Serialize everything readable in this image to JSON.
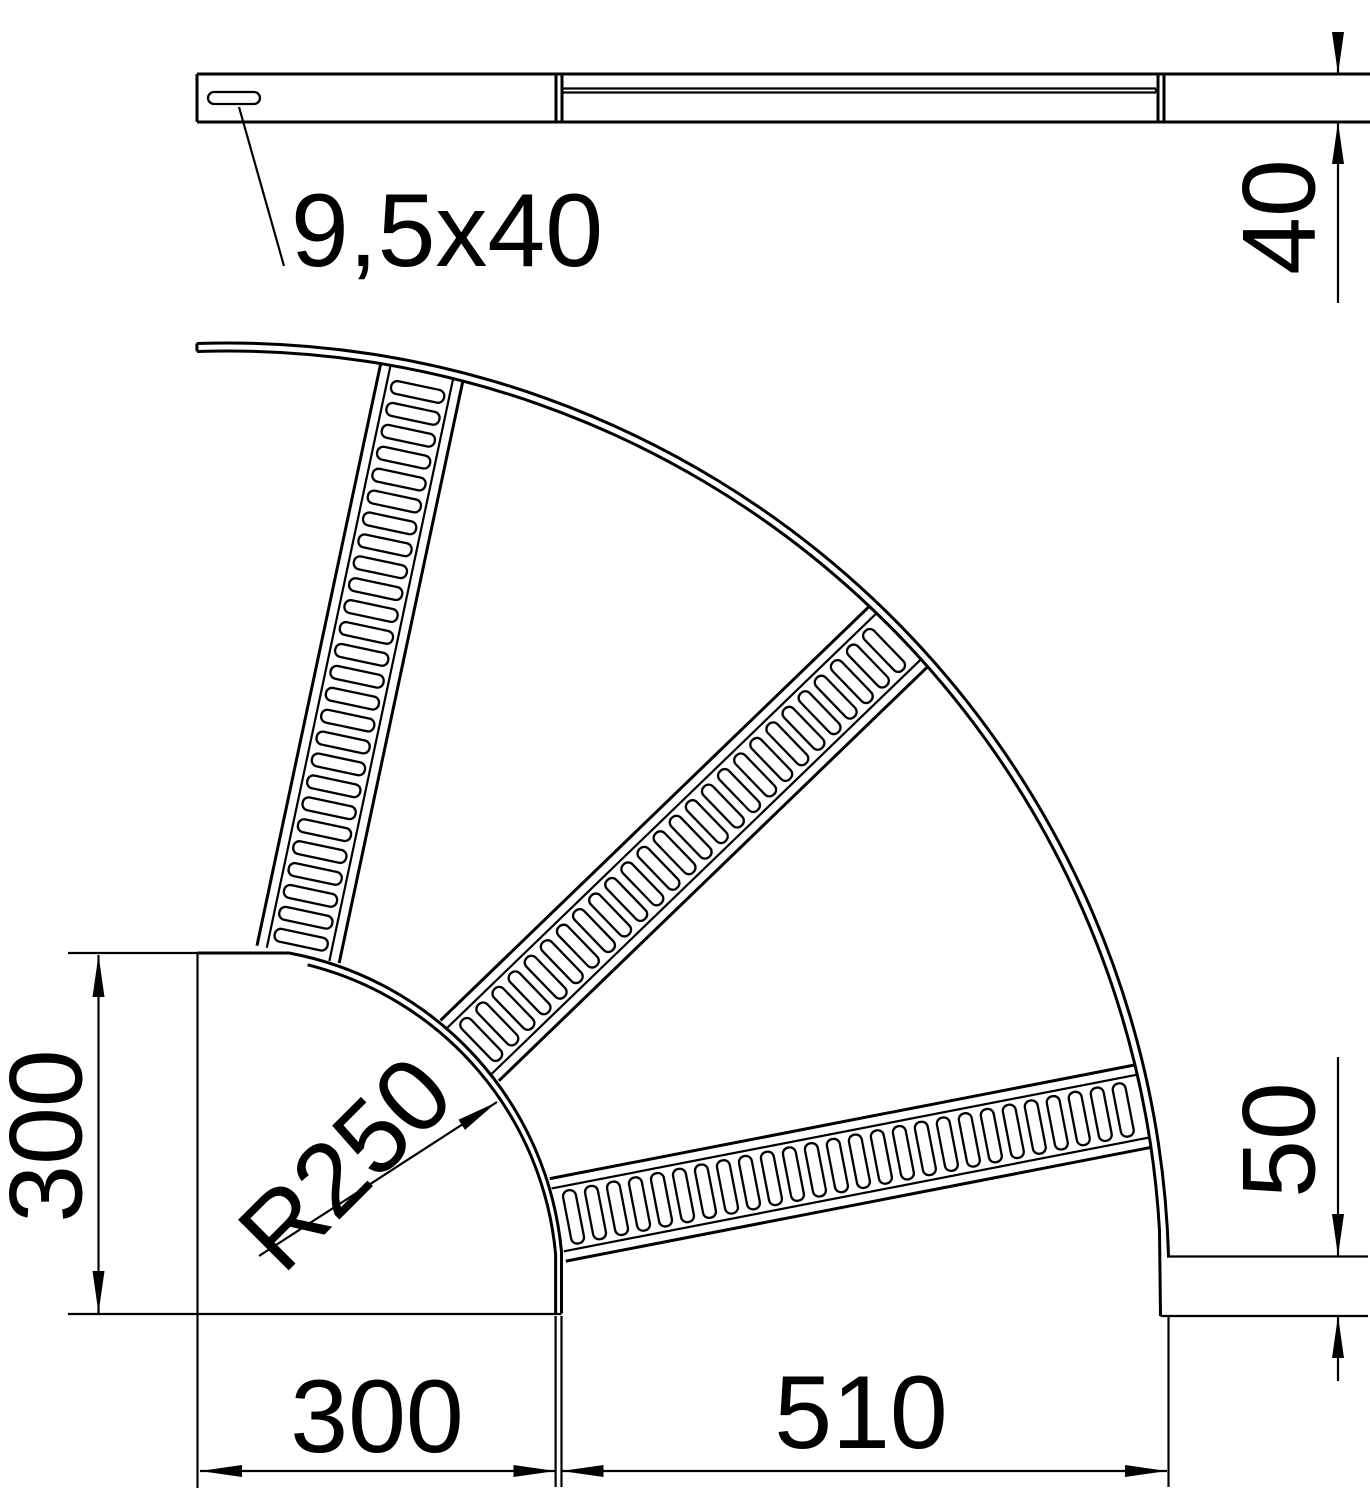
{
  "drawing": {
    "background_color": "#ffffff",
    "line_color": "#000000",
    "top_view": {
      "slot_size_label": "9,5x40",
      "rail_height_label": "40"
    },
    "plan_view": {
      "radius_label": "R250",
      "left_width_label": "300",
      "bottom_width_label": "300",
      "bottom_outer_label": "510",
      "rail_depth_label": "50"
    }
  }
}
